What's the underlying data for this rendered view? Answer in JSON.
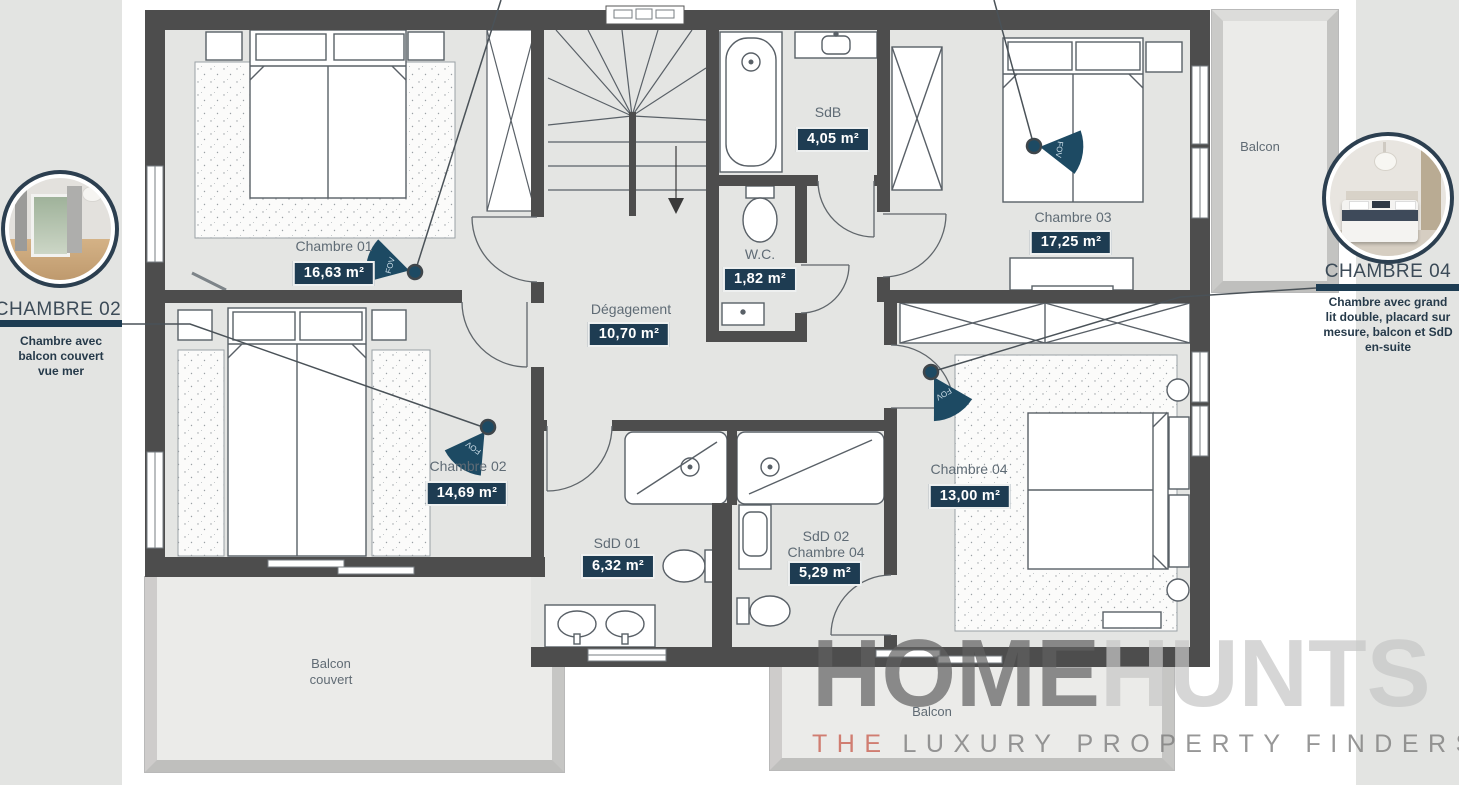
{
  "palette": {
    "wall": "#4d4d4d",
    "floor": "#e4e5e3",
    "badge_bg": "#1e3c52",
    "accent_bar": "#1d3c52",
    "label_text": "#5f6b75",
    "fov_fill": "#1d4a63",
    "tagline_lead_color": "#cb6a5c"
  },
  "rooms": {
    "chambre01": {
      "label": "Chambre 01",
      "area": "16,63 m²"
    },
    "chambre02": {
      "label": "Chambre 02",
      "area": "14,69 m²"
    },
    "chambre03": {
      "label": "Chambre 03",
      "area": "17,25 m²"
    },
    "chambre04": {
      "label": "Chambre 04",
      "area": "13,00 m²"
    },
    "sdb": {
      "label": "SdB",
      "area": "4,05 m²"
    },
    "wc": {
      "label": "W.C.",
      "area": "1,82 m²"
    },
    "degagement": {
      "label": "Dégagement",
      "area": "10,70 m²"
    },
    "sdd01": {
      "label": "SdD 01",
      "area": "6,32 m²"
    },
    "sdd02": {
      "label": "SdD 02\nChambre 04",
      "area": "5,29 m²"
    }
  },
  "zones": {
    "balcon_right": "Balcon",
    "balcon_couvert": "Balcon\ncouvert",
    "balcon_bottom": "Balcon"
  },
  "insets": {
    "left": {
      "title": "CHAMBRE 02",
      "caption": "Chambre avec\nbalcon couvert\nvue mer"
    },
    "right": {
      "title": "CHAMBRE 04",
      "caption": "Chambre avec grand\nlit double, placard sur\nmesure, balcon et SdD\nen-suite"
    }
  },
  "fov": {
    "label": "FOV"
  },
  "watermark": {
    "brand_primary": "HOME",
    "brand_secondary": "HUNTS",
    "tagline_lead": "THE",
    "tagline_rest": "LUXURY PROPERTY FINDERS"
  }
}
